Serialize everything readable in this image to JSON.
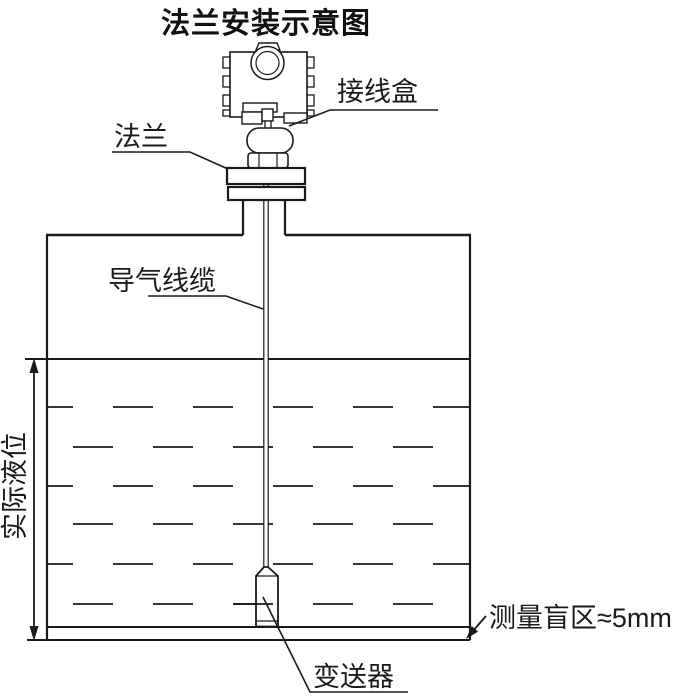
{
  "title": "法兰安装示意图",
  "labels": {
    "junction_box": "接线盒",
    "flange": "法兰",
    "air_cable": "导气线缆",
    "actual_level": "实际液位",
    "transmitter": "变送器",
    "blind_zone": "测量盲区≈5mm"
  },
  "annotations": {
    "blind_zone_value": "≈5mm",
    "actual_level_orientation": "vertical-rotated-90ccw"
  },
  "colors": {
    "background": "#ffffff",
    "line": "#1a1a1a",
    "text": "#1a1a1a"
  },
  "diagram": {
    "type": "installation-schematic",
    "components": [
      "junction-box-head",
      "flange-plate",
      "tank-nozzle",
      "air-guide-cable",
      "storage-tank",
      "liquid-with-dashed-pattern",
      "submerged-transmitter-probe",
      "level-dimension-arrow",
      "blind-zone-arrow"
    ]
  }
}
